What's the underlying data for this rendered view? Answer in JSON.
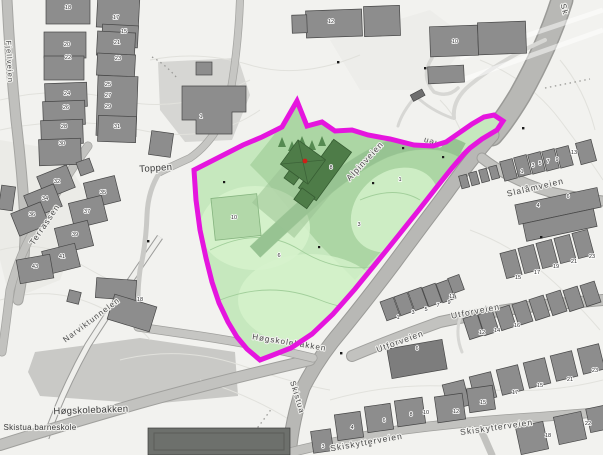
{
  "map": {
    "colors": {
      "background": "#f2f2ef",
      "boundary": "#e515de",
      "area_fill": "#c6e8be",
      "area_fill_medium": "#a9d4a1",
      "area_fill_light": "#d6f2cc",
      "corridor": "#9dc898",
      "dark_building_green": "#4e7c48",
      "building_gray": "#8d8d8d",
      "road_gray": "#c2c2bf",
      "major_road_gray": "#b8b8b5",
      "marker_red": "#cf2018",
      "tree_green": "#568a52"
    },
    "marker": {
      "x": 305,
      "y": 161
    },
    "street_labels": [
      {
        "name": "fjellveien-label",
        "text": "Fjellveien",
        "x": 7,
        "y": 62,
        "rot": 87,
        "size": 7.5,
        "kind": "street"
      },
      {
        "name": "toppen-label",
        "text": "Toppen",
        "x": 156,
        "y": 171,
        "rot": -4,
        "size": 9.5,
        "kind": "area"
      },
      {
        "name": "terrassen-label",
        "text": "Terrassen",
        "x": 47,
        "y": 226,
        "rot": -56,
        "size": 8.5,
        "kind": "street"
      },
      {
        "name": "narviktunnelen-label",
        "text": "Narviktunnelen",
        "x": 93,
        "y": 322,
        "rot": -37,
        "size": 8,
        "kind": "street"
      },
      {
        "name": "hogskolebakken-area-label",
        "text": "Høgskolebakken",
        "x": 91,
        "y": 413,
        "rot": -2,
        "size": 9.5,
        "kind": "area"
      },
      {
        "name": "skistua-barneskole-label",
        "text": "Skistua barneskole",
        "x": 40,
        "y": 430,
        "rot": 0,
        "size": 8,
        "kind": "area"
      },
      {
        "name": "hogskolebakken-road-label",
        "text": "Høgskolebakken",
        "x": 289,
        "y": 345,
        "rot": 9,
        "size": 8,
        "kind": "street"
      },
      {
        "name": "skistua-road-label",
        "text": "Skistua",
        "x": 295,
        "y": 398,
        "rot": 73,
        "size": 8,
        "kind": "street"
      },
      {
        "name": "alpinveien-label",
        "text": "Alpinveien",
        "x": 367,
        "y": 163,
        "rot": -47,
        "size": 8.5,
        "kind": "street"
      },
      {
        "name": "alpinveien-fragment-label",
        "text": "eien",
        "x": 433,
        "y": 140,
        "rot": 196,
        "size": 8,
        "kind": "street"
      },
      {
        "name": "road-top-right-label",
        "text": "Sk",
        "x": 562,
        "y": 10,
        "rot": 75,
        "size": 8,
        "kind": "street"
      },
      {
        "name": "slalamveien-label",
        "text": "Slalåmveien",
        "x": 536,
        "y": 190,
        "rot": -13,
        "size": 8.5,
        "kind": "street"
      },
      {
        "name": "utforveien-sw-label",
        "text": "Utforveien",
        "x": 401,
        "y": 344,
        "rot": -20,
        "size": 8.5,
        "kind": "street"
      },
      {
        "name": "utforveien-ne-label",
        "text": "Utforveien",
        "x": 476,
        "y": 314,
        "rot": -11,
        "size": 8.5,
        "kind": "street"
      },
      {
        "name": "skiskytterveien-w-label",
        "text": "Skiskytterveien",
        "x": 367,
        "y": 445,
        "rot": -10,
        "size": 8.5,
        "kind": "street"
      },
      {
        "name": "skiskytterveien-e-label",
        "text": "Skiskytterveien",
        "x": 497,
        "y": 430,
        "rot": -8,
        "size": 8.5,
        "kind": "street"
      }
    ],
    "house_numbers": [
      {
        "t": "18",
        "x": 68,
        "y": 9
      },
      {
        "t": "17",
        "x": 116,
        "y": 19
      },
      {
        "t": "15",
        "x": 124,
        "y": 33
      },
      {
        "t": "20",
        "x": 67,
        "y": 46
      },
      {
        "t": "21",
        "x": 117,
        "y": 44
      },
      {
        "t": "22",
        "x": 68,
        "y": 59
      },
      {
        "t": "23",
        "x": 118,
        "y": 60
      },
      {
        "t": "24",
        "x": 67,
        "y": 95
      },
      {
        "t": "25",
        "x": 108,
        "y": 86
      },
      {
        "t": "27",
        "x": 108,
        "y": 97
      },
      {
        "t": "29",
        "x": 108,
        "y": 108
      },
      {
        "t": "26",
        "x": 66,
        "y": 109
      },
      {
        "t": "28",
        "x": 64,
        "y": 128
      },
      {
        "t": "31",
        "x": 117,
        "y": 128
      },
      {
        "t": "30",
        "x": 62,
        "y": 145
      },
      {
        "t": "32",
        "x": 57,
        "y": 183
      },
      {
        "t": "34",
        "x": 45,
        "y": 200
      },
      {
        "t": "36",
        "x": 32,
        "y": 216
      },
      {
        "t": "35",
        "x": 103,
        "y": 194
      },
      {
        "t": "37",
        "x": 87,
        "y": 213
      },
      {
        "t": "39",
        "x": 75,
        "y": 236
      },
      {
        "t": "41",
        "x": 62,
        "y": 258
      },
      {
        "t": "43",
        "x": 35,
        "y": 268
      },
      {
        "t": "18",
        "x": 140,
        "y": 301
      },
      {
        "t": "12",
        "x": 331,
        "y": 23
      },
      {
        "t": "10",
        "x": 455,
        "y": 43
      },
      {
        "t": "1",
        "x": 201,
        "y": 118
      },
      {
        "t": "8",
        "x": 331,
        "y": 169
      },
      {
        "t": "10",
        "x": 234,
        "y": 219
      },
      {
        "t": "6",
        "x": 279,
        "y": 257
      },
      {
        "t": "3",
        "x": 359,
        "y": 226
      },
      {
        "t": "1",
        "x": 400,
        "y": 181
      },
      {
        "t": "1",
        "x": 522,
        "y": 173
      },
      {
        "t": "3",
        "x": 533,
        "y": 167
      },
      {
        "t": "5",
        "x": 540,
        "y": 165
      },
      {
        "t": "7",
        "x": 548,
        "y": 163
      },
      {
        "t": "9",
        "x": 557,
        "y": 161
      },
      {
        "t": "13",
        "x": 574,
        "y": 154
      },
      {
        "t": "4",
        "x": 538,
        "y": 207
      },
      {
        "t": "6",
        "x": 568,
        "y": 198
      },
      {
        "t": "15",
        "x": 518,
        "y": 279
      },
      {
        "t": "17",
        "x": 537,
        "y": 274
      },
      {
        "t": "19",
        "x": 556,
        "y": 268
      },
      {
        "t": "21",
        "x": 574,
        "y": 263
      },
      {
        "t": "23",
        "x": 592,
        "y": 258
      },
      {
        "t": "1",
        "x": 398,
        "y": 319
      },
      {
        "t": "3",
        "x": 413,
        "y": 314
      },
      {
        "t": "5",
        "x": 426,
        "y": 311
      },
      {
        "t": "7",
        "x": 438,
        "y": 307
      },
      {
        "t": "9",
        "x": 449,
        "y": 304
      },
      {
        "t": "11",
        "x": 452,
        "y": 298
      },
      {
        "t": "6",
        "x": 417,
        "y": 350
      },
      {
        "t": "12",
        "x": 482,
        "y": 334
      },
      {
        "t": "14",
        "x": 497,
        "y": 332
      },
      {
        "t": "16",
        "x": 517,
        "y": 327
      },
      {
        "t": "15",
        "x": 540,
        "y": 387
      },
      {
        "t": "17",
        "x": 515,
        "y": 394
      },
      {
        "t": "21",
        "x": 570,
        "y": 381
      },
      {
        "t": "23",
        "x": 595,
        "y": 372
      },
      {
        "t": "3",
        "x": 323,
        "y": 448
      },
      {
        "t": "4",
        "x": 352,
        "y": 429
      },
      {
        "t": "6",
        "x": 384,
        "y": 422
      },
      {
        "t": "8",
        "x": 411,
        "y": 416
      },
      {
        "t": "10",
        "x": 426,
        "y": 414
      },
      {
        "t": "12",
        "x": 456,
        "y": 413
      },
      {
        "t": "15",
        "x": 483,
        "y": 404
      },
      {
        "t": "18",
        "x": 548,
        "y": 437
      },
      {
        "t": "22",
        "x": 588,
        "y": 425
      }
    ]
  }
}
